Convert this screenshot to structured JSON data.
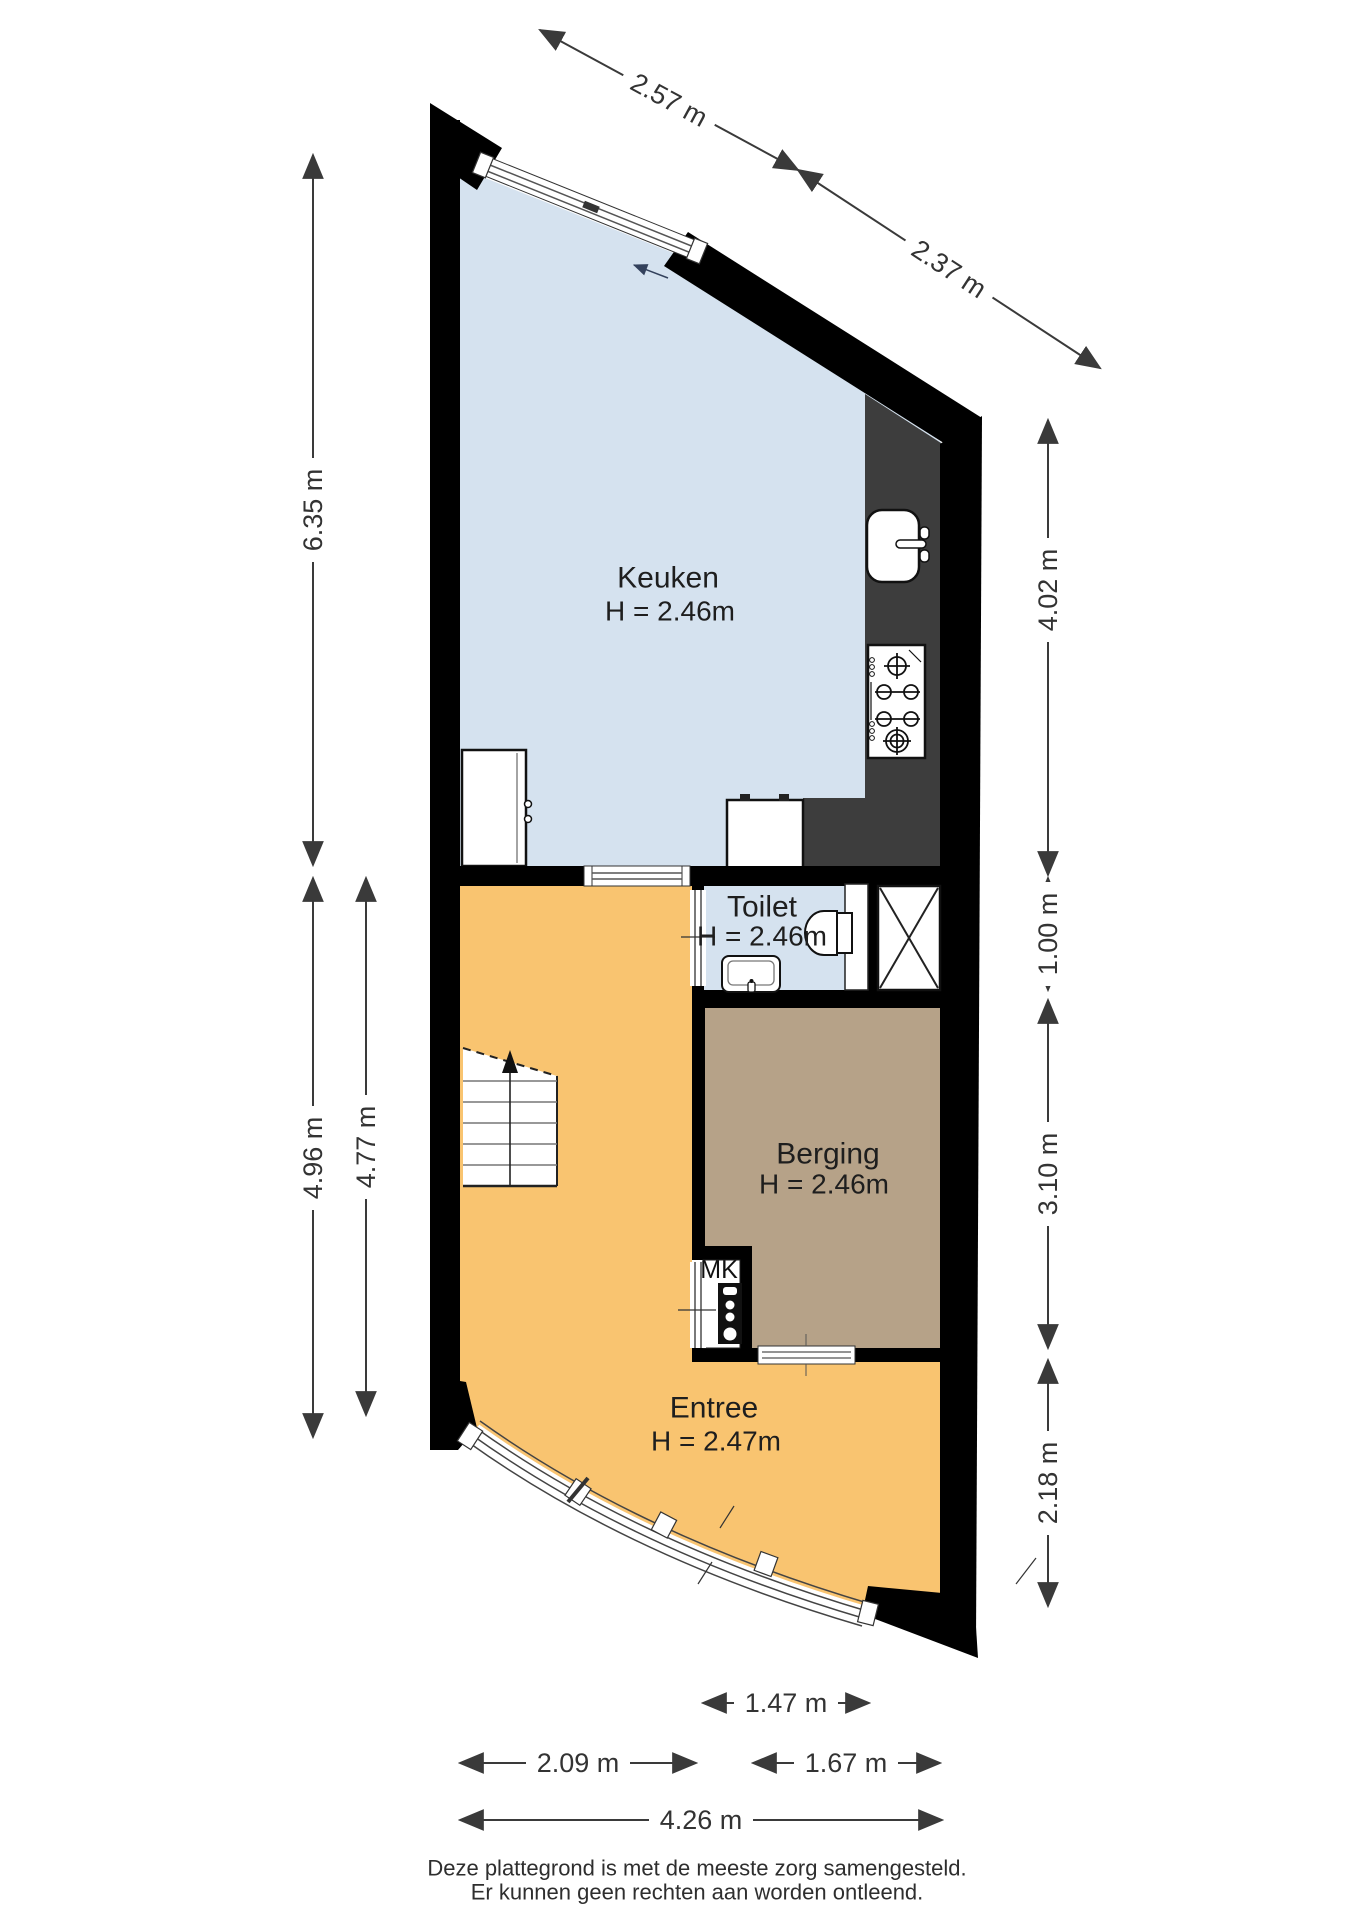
{
  "rooms": {
    "keuken": {
      "label": "Keuken",
      "height": "H = 2.46m"
    },
    "toilet": {
      "label": "Toilet",
      "height": "H = 2.46m"
    },
    "berging": {
      "label": "Berging",
      "height": "H = 2.46m"
    },
    "entree": {
      "label": "Entree",
      "height": "H = 2.47m"
    },
    "mk": {
      "label": "MK"
    }
  },
  "dimensions": {
    "top_left": "2.57 m",
    "top_right": "2.37 m",
    "left_total": "6.35 m",
    "left_lower_outer": "4.96 m",
    "left_lower_inner": "4.77 m",
    "right_kitchen": "4.02 m",
    "right_toilet": "1.00 m",
    "right_berging": "3.10 m",
    "right_entree": "2.18 m",
    "bottom_inner": "1.47 m",
    "bottom_left": "2.09 m",
    "bottom_right": "1.67 m",
    "bottom_total": "4.26 m"
  },
  "footer": {
    "line1": "Deze plattegrond is met de meeste zorg samengesteld.",
    "line2": "Er kunnen geen rechten aan worden ontleend."
  },
  "colors": {
    "keuken_floor": "#d5e2ef",
    "toilet_floor": "#d5e2ef",
    "entree_floor": "#f9c470",
    "berging_floor": "#b6a288",
    "counter": "#3d3d3d",
    "wall": "#000000",
    "dim": "#3a3a3a"
  },
  "icons": {
    "stove": "gas-hob-6-burners",
    "sink": "kitchen-sink",
    "wc": "toilet-bowl",
    "basin": "washbasin",
    "meter": "meter-cupboard-panel",
    "stairs": "staircase-up-arrow",
    "shaft": "shaft-cross"
  }
}
